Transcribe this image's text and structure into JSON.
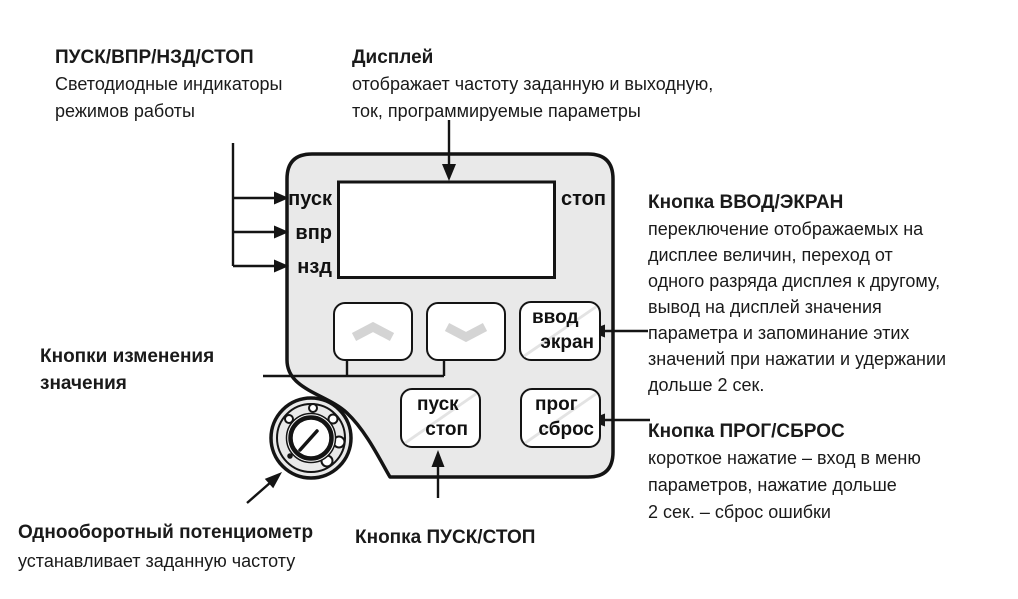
{
  "colors": {
    "panel_fill": "#e9e9e9",
    "outline": "#141414",
    "button_fill": "#ffffff",
    "chevron_gray": "#d4d4d4",
    "divider_gray": "#e3e3e3"
  },
  "panel": {
    "indicators": {
      "start": "пуск",
      "forward": "впр",
      "reverse": "нзд",
      "stop": "стоп"
    },
    "buttons": {
      "up": {
        "icon": "chevron-up"
      },
      "down": {
        "icon": "chevron-down"
      },
      "enter_screen": {
        "top": "ввод",
        "bottom": "экран"
      },
      "start_stop": {
        "top": "пуск",
        "bottom": "стоп"
      },
      "prog_reset": {
        "top": "прог",
        "bottom": "сброс"
      }
    }
  },
  "annotations": {
    "leds": {
      "title": "ПУСК/ВПР/НЗД/СТОП",
      "lines": [
        "Светодиодные индикаторы",
        "режимов работы"
      ]
    },
    "display": {
      "title": "Дисплей",
      "lines": [
        "отображает частоту заданную и выходную,",
        "ток, программируемые параметры"
      ]
    },
    "enter_screen": {
      "title": "Кнопка ВВОД/ЭКРАН",
      "lines": [
        "переключение отображаемых на",
        "дисплее величин, переход от",
        "одного разряда дисплея к другому,",
        "вывод на дисплей значения",
        "параметра и запоминание этих",
        "значений при нажатии и удержании",
        "дольше 2 сек."
      ]
    },
    "prog_reset": {
      "title": "Кнопка ПРОГ/СБРОС",
      "lines": [
        "короткое нажатие – вход в меню",
        "параметров, нажатие дольше",
        "2 сек. – сброс ошибки"
      ]
    },
    "value_buttons": {
      "lines": [
        "Кнопки изменения",
        "значения"
      ]
    },
    "potentiometer": {
      "title": "Однооборотный потенциометр",
      "lines": [
        "устанавливает заданную частоту"
      ]
    },
    "start_stop": {
      "title": "Кнопка ПУСК/СТОП"
    }
  }
}
